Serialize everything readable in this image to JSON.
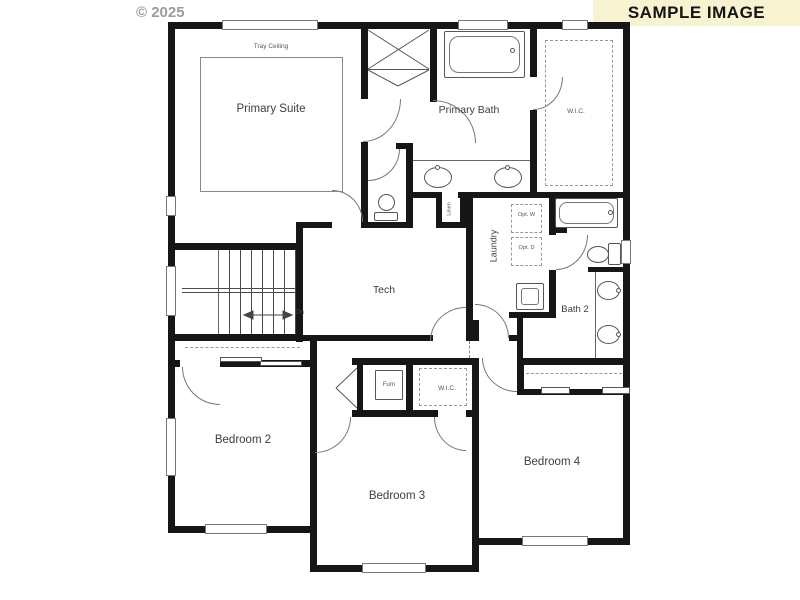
{
  "meta": {
    "copyright": "© 2025",
    "banner_text": "SAMPLE IMAGE"
  },
  "colors": {
    "wall": "#161616",
    "banner_bg": "#f7f2cf",
    "fixture_line": "#555555",
    "label": "#3d3d3d",
    "dash": "#999999"
  },
  "rooms": {
    "primary_suite": "Primary Suite",
    "tray_ceiling": "Tray Ceiling",
    "primary_bath": "Primary Bath",
    "wic_primary": "W.I.C.",
    "linen": "Linen",
    "laundry": "Laundry",
    "opt_washer": "Opt. W",
    "opt_dryer": "Opt. D",
    "tech": "Tech",
    "bath2": "Bath 2",
    "stairs_down": "Dn",
    "furnace": "Furn",
    "wic_bedroom3": "W.I.C.",
    "bedroom2": "Bedroom 2",
    "bedroom3": "Bedroom 3",
    "bedroom4": "Bedroom 4"
  }
}
